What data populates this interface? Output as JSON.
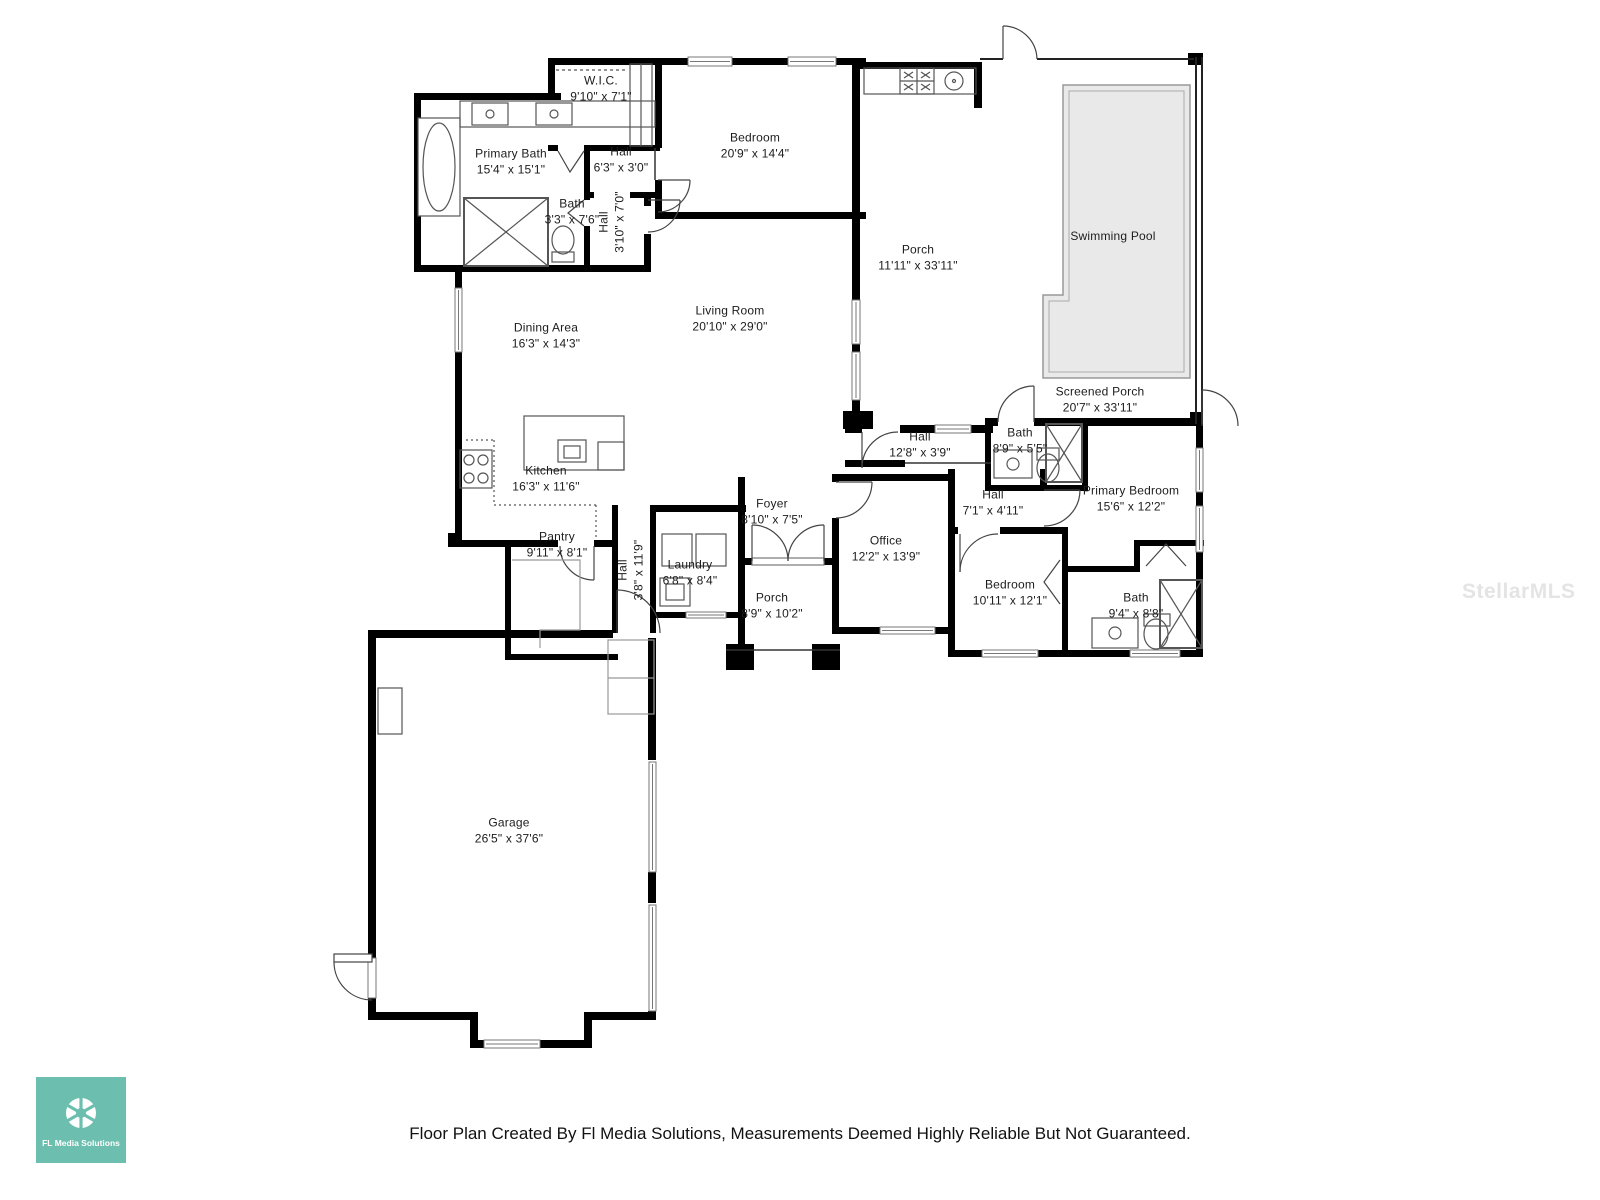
{
  "page": {
    "background": "#ffffff"
  },
  "colors": {
    "wall": "#000000",
    "pool_fill": "#e9e9e9",
    "fixture_stroke": "#555555",
    "logo_teal": "#6cbfae",
    "watermark_gray": "#e4e4e4"
  },
  "watermark": {
    "text": "StellarMLS"
  },
  "footer": {
    "disclaimer": "Floor Plan Created By Fl Media Solutions, Measurements Deemed Highly Reliable But Not Guaranteed."
  },
  "logo": {
    "text": "FL Media Solutions",
    "icon": "aperture-icon"
  },
  "rooms": [
    {
      "name": "W.I.C.",
      "dims": "9'10\" x 7'1\""
    },
    {
      "name": "Primary Bath",
      "dims": "15'4\" x 15'1\""
    },
    {
      "name": "Hall",
      "dims": "6'3\" x 3'0\""
    },
    {
      "name": "Bath",
      "dims": "3'3\" x 7'6\""
    },
    {
      "name": "Hall",
      "dims": "3'10\" x 7'0\""
    },
    {
      "name": "Bedroom",
      "dims": "20'9\" x 14'4\""
    },
    {
      "name": "Porch",
      "dims": "11'11\" x 33'11\""
    },
    {
      "name": "Swimming Pool",
      "dims": ""
    },
    {
      "name": "Screened Porch",
      "dims": "20'7\" x 33'11\""
    },
    {
      "name": "Living Room",
      "dims": "20'10\" x 29'0\""
    },
    {
      "name": "Dining Area",
      "dims": "16'3\" x 14'3\""
    },
    {
      "name": "Kitchen",
      "dims": "16'3\" x 11'6\""
    },
    {
      "name": "Pantry",
      "dims": "9'11\" x 8'1\""
    },
    {
      "name": "Hall",
      "dims": "3'8\" x 11'9\""
    },
    {
      "name": "Laundry",
      "dims": "6'8\" x 8'4\""
    },
    {
      "name": "Foyer",
      "dims": "8'10\" x 7'5\""
    },
    {
      "name": "Porch",
      "dims": "8'9\" x 10'2\""
    },
    {
      "name": "Office",
      "dims": "12'2\" x 13'9\""
    },
    {
      "name": "Hall",
      "dims": "12'8\" x 3'9\""
    },
    {
      "name": "Bath",
      "dims": "8'9\" x 5'5\""
    },
    {
      "name": "Hall",
      "dims": "7'1\" x 4'11\""
    },
    {
      "name": "Primary Bedroom",
      "dims": "15'6\" x 12'2\""
    },
    {
      "name": "Bedroom",
      "dims": "10'11\" x 12'1\""
    },
    {
      "name": "Bath",
      "dims": "9'4\" x 8'8\""
    },
    {
      "name": "Garage",
      "dims": "26'5\" x 37'6\""
    }
  ]
}
